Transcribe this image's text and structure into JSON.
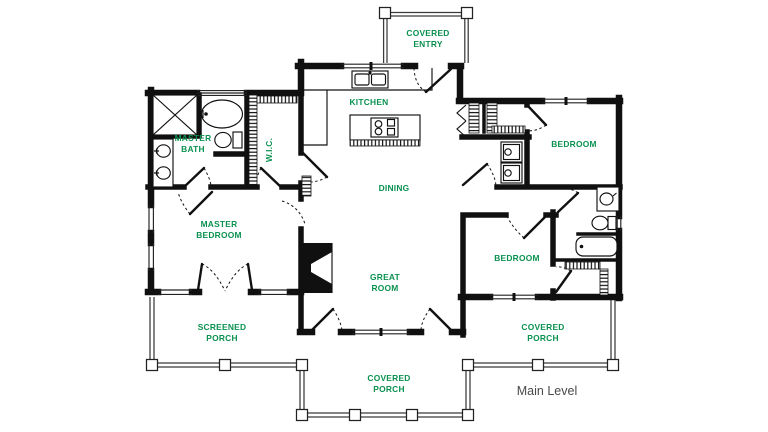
{
  "title": "Main Level floor plan",
  "colors": {
    "label_green": "#0a9150",
    "wall_black": "#101010",
    "level_gray": "#4a4a4a"
  },
  "rooms": {
    "covered_entry": {
      "line1": "COVERED",
      "line2": "ENTRY"
    },
    "kitchen": {
      "line1": "KITCHEN"
    },
    "master_bath": {
      "line1": "MASTER",
      "line2": "BATH"
    },
    "wic": {
      "line1": "W.I.C."
    },
    "dining": {
      "line1": "DINING"
    },
    "bedroom_upper": {
      "line1": "BEDROOM"
    },
    "master_bedroom": {
      "line1": "MASTER",
      "line2": "BEDROOM"
    },
    "great_room": {
      "line1": "GREAT",
      "line2": "ROOM"
    },
    "bedroom_lower": {
      "line1": "BEDROOM"
    },
    "screened_porch": {
      "line1": "SCREENED",
      "line2": "PORCH"
    },
    "covered_porch_side": {
      "line1": "COVERED",
      "line2": "PORCH"
    },
    "covered_porch_bottom": {
      "line1": "COVERED",
      "line2": "PORCH"
    }
  },
  "footer": {
    "level_label": "Main Level"
  }
}
